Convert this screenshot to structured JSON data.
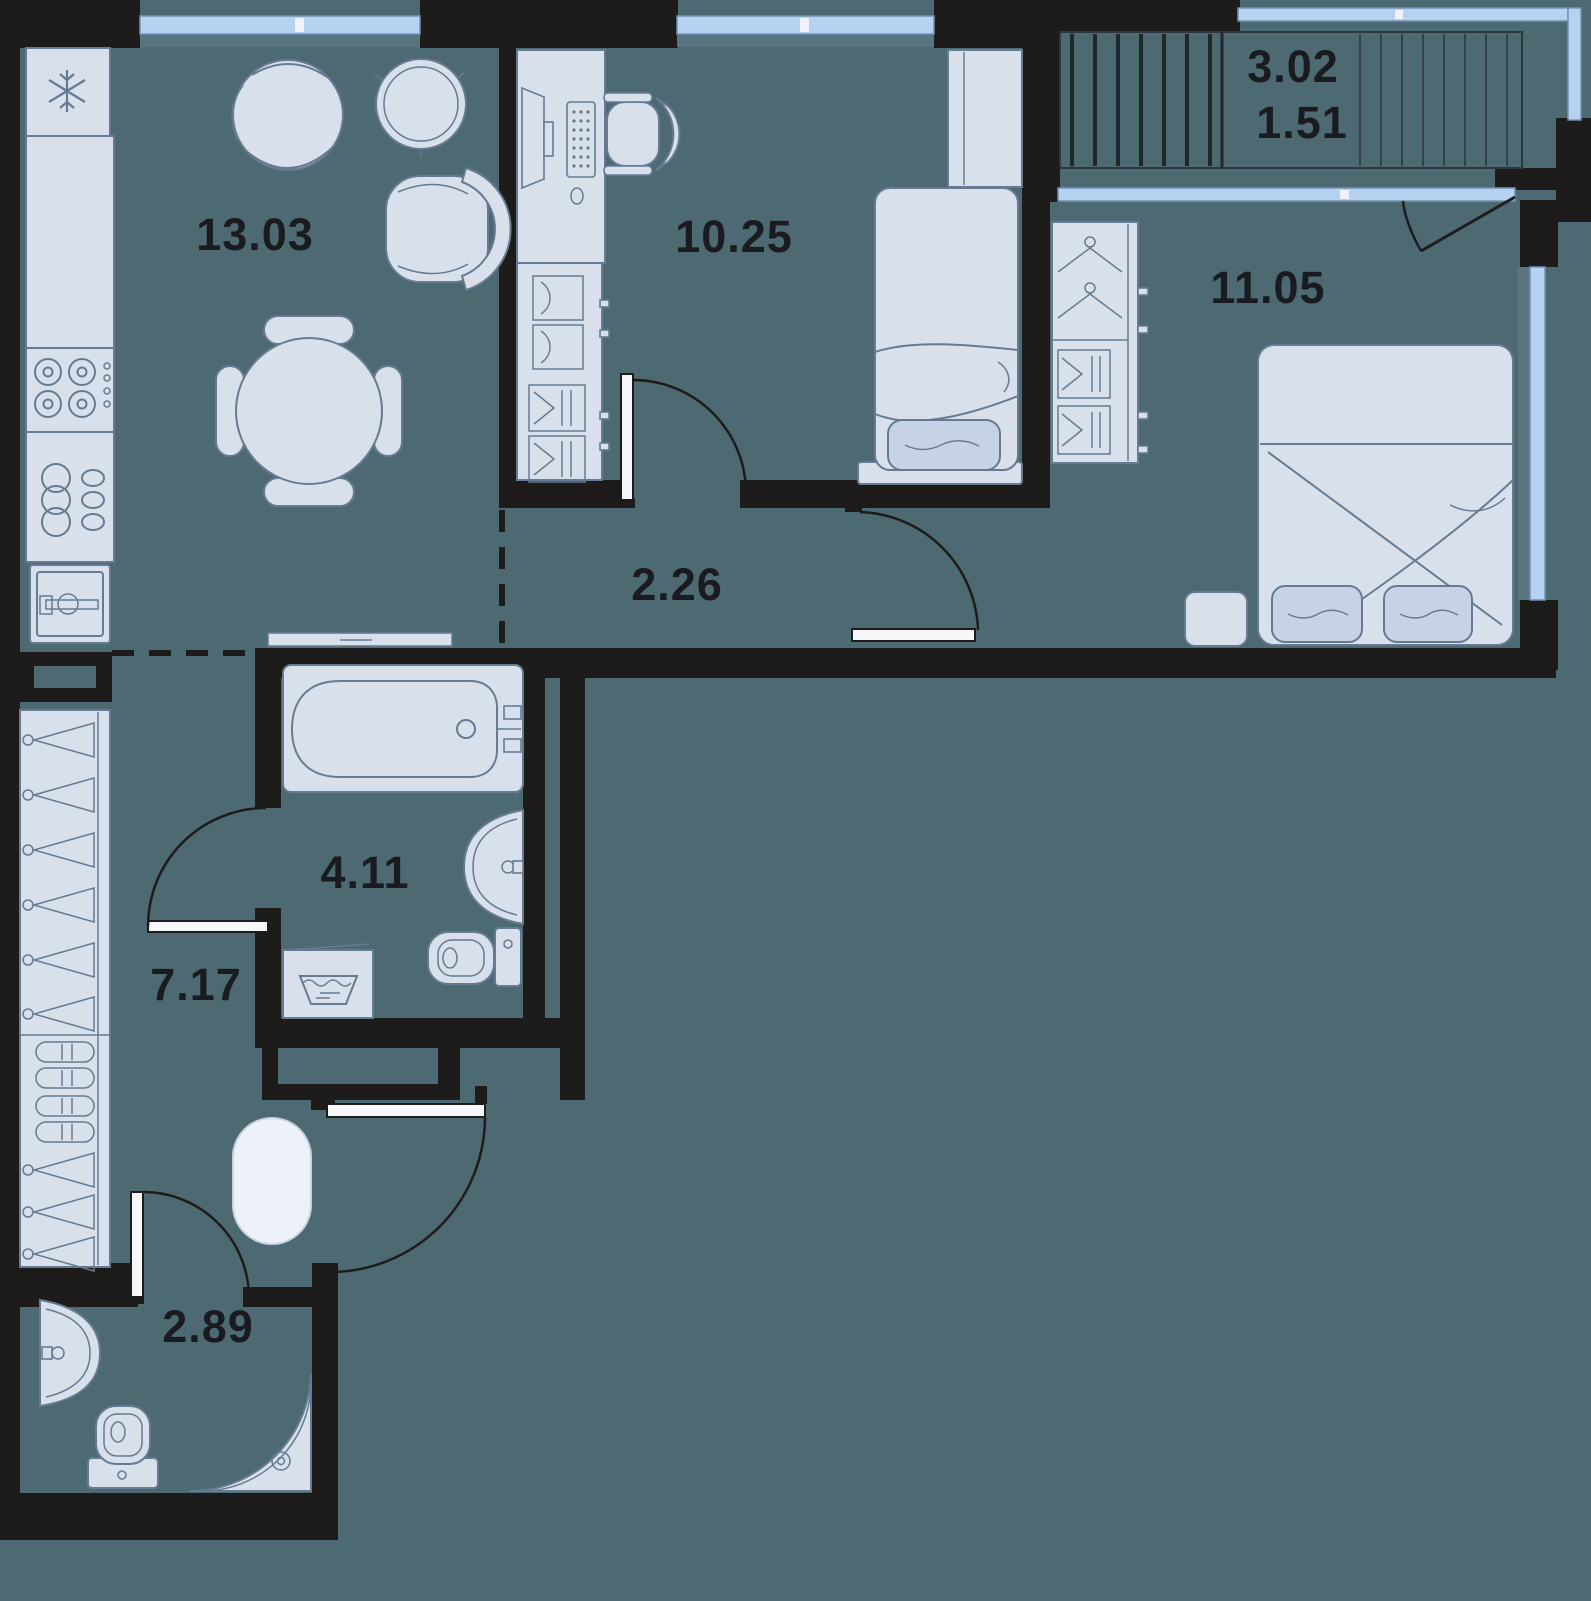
{
  "colors": {
    "background": "#4d6a73",
    "walls": "#1e1c1b",
    "furniture_fill": "#d8e0eb",
    "furniture_stroke": "#667b92",
    "window_glass": "#b7d1f0",
    "label_text": "#191b20"
  },
  "rooms": [
    {
      "name": "kitchen-living-room",
      "area": "13.03"
    },
    {
      "name": "office-bedroom",
      "area": "10.25"
    },
    {
      "name": "bedroom",
      "area": "11.05"
    },
    {
      "name": "hallway",
      "area": "2.26"
    },
    {
      "name": "bathroom",
      "area": "4.11"
    },
    {
      "name": "corridor",
      "area": "7.17"
    },
    {
      "name": "shower-room",
      "area": "2.89"
    },
    {
      "name": "balcony",
      "area": "3.02",
      "area_reduced": "1.51"
    }
  ]
}
